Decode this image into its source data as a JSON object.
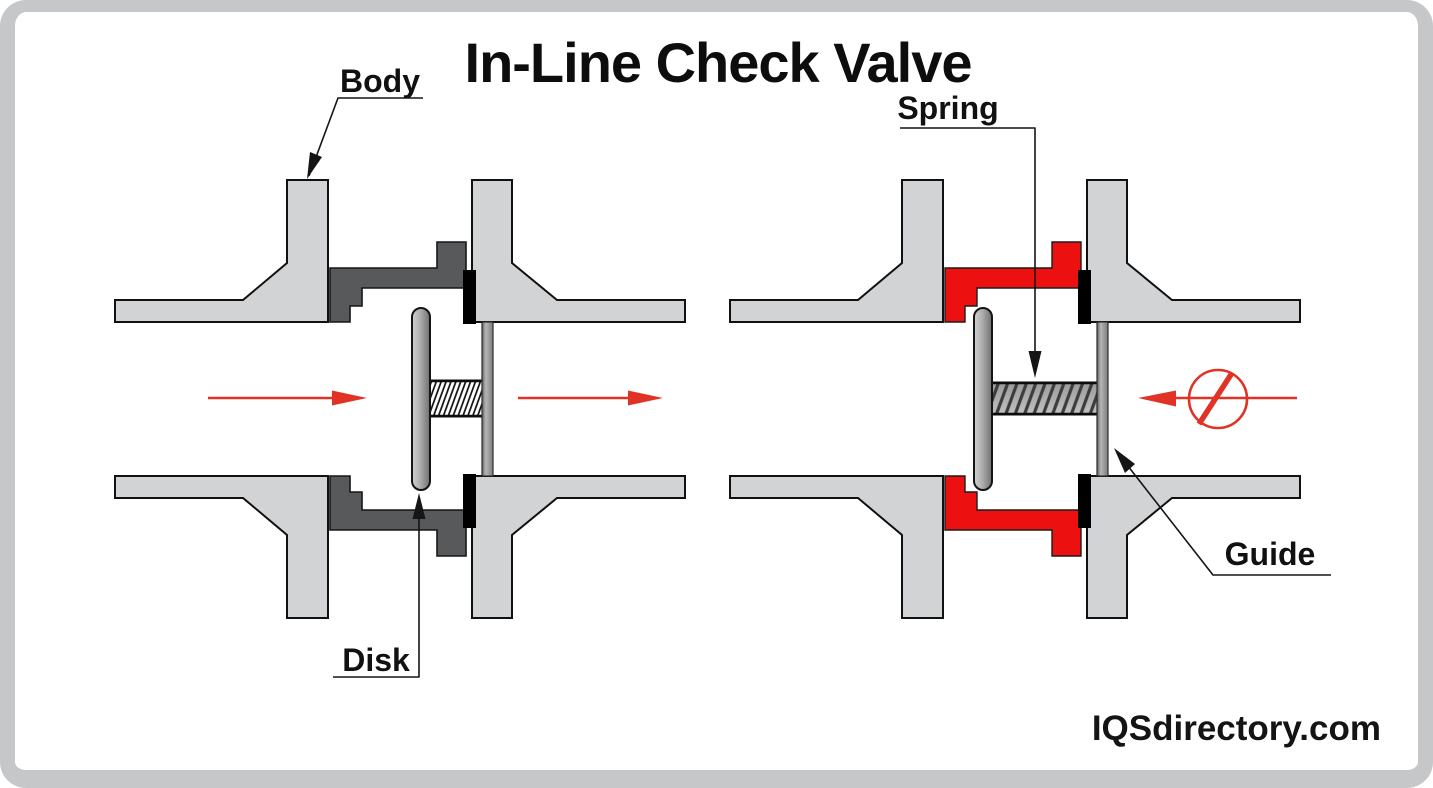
{
  "title": "In-Line Check Valve",
  "watermark": "IQSdirectory.com",
  "labels": {
    "body": "Body",
    "spring": "Spring",
    "disk": "Disk",
    "guide": "Guide"
  },
  "icons": {
    "forward-flow-arrow-icon": "→",
    "blocked-flow-icon": "⊘"
  },
  "colors": {
    "flange_gray": "#d2d3d4",
    "valve_body_gray": "#58595b",
    "valve_body_red": "#ed1010",
    "seat_black": "#000000",
    "flow_arrow_red": "#e13226",
    "spring_fill_open": "#ffffff",
    "spring_fill_closed": "#aeaeae",
    "frame_gray": "#c5c7c9",
    "text_black": "#111111"
  }
}
